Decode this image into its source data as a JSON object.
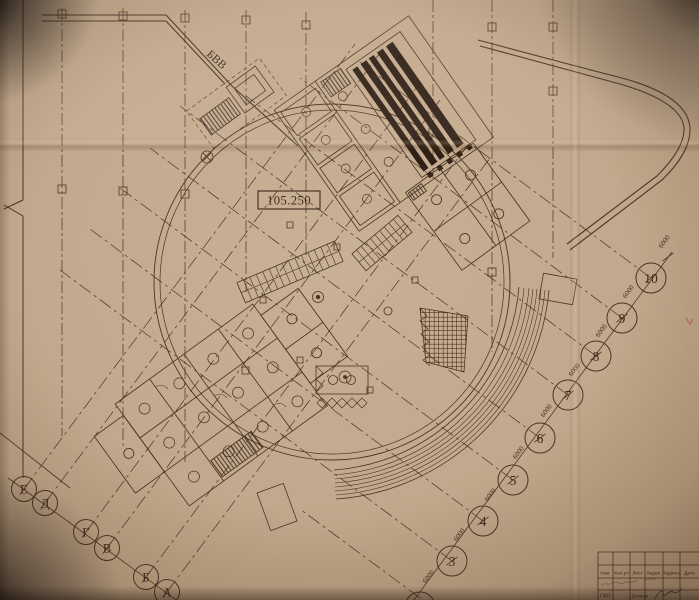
{
  "plan": {
    "elevation_mark": "105.250",
    "utility_line_label": "БВВ",
    "dimension_label": "6000",
    "numbered_axes": [
      "3",
      "4",
      "5",
      "6",
      "7",
      "8",
      "9",
      "10"
    ],
    "letter_axes": [
      "Е",
      "Д",
      "Г",
      "В",
      "Б",
      "А"
    ]
  },
  "title_block": {
    "headers": [
      "Изм.",
      "Кол.уч",
      "Лист",
      "№док.",
      "Подпись",
      "Дата"
    ],
    "approved_by_role": "ГИП",
    "approved_by_name": "Волков"
  },
  "colors": {
    "paper": "#c2a88c",
    "ink": "#4a3525",
    "dark_fill": "#2e2014"
  }
}
